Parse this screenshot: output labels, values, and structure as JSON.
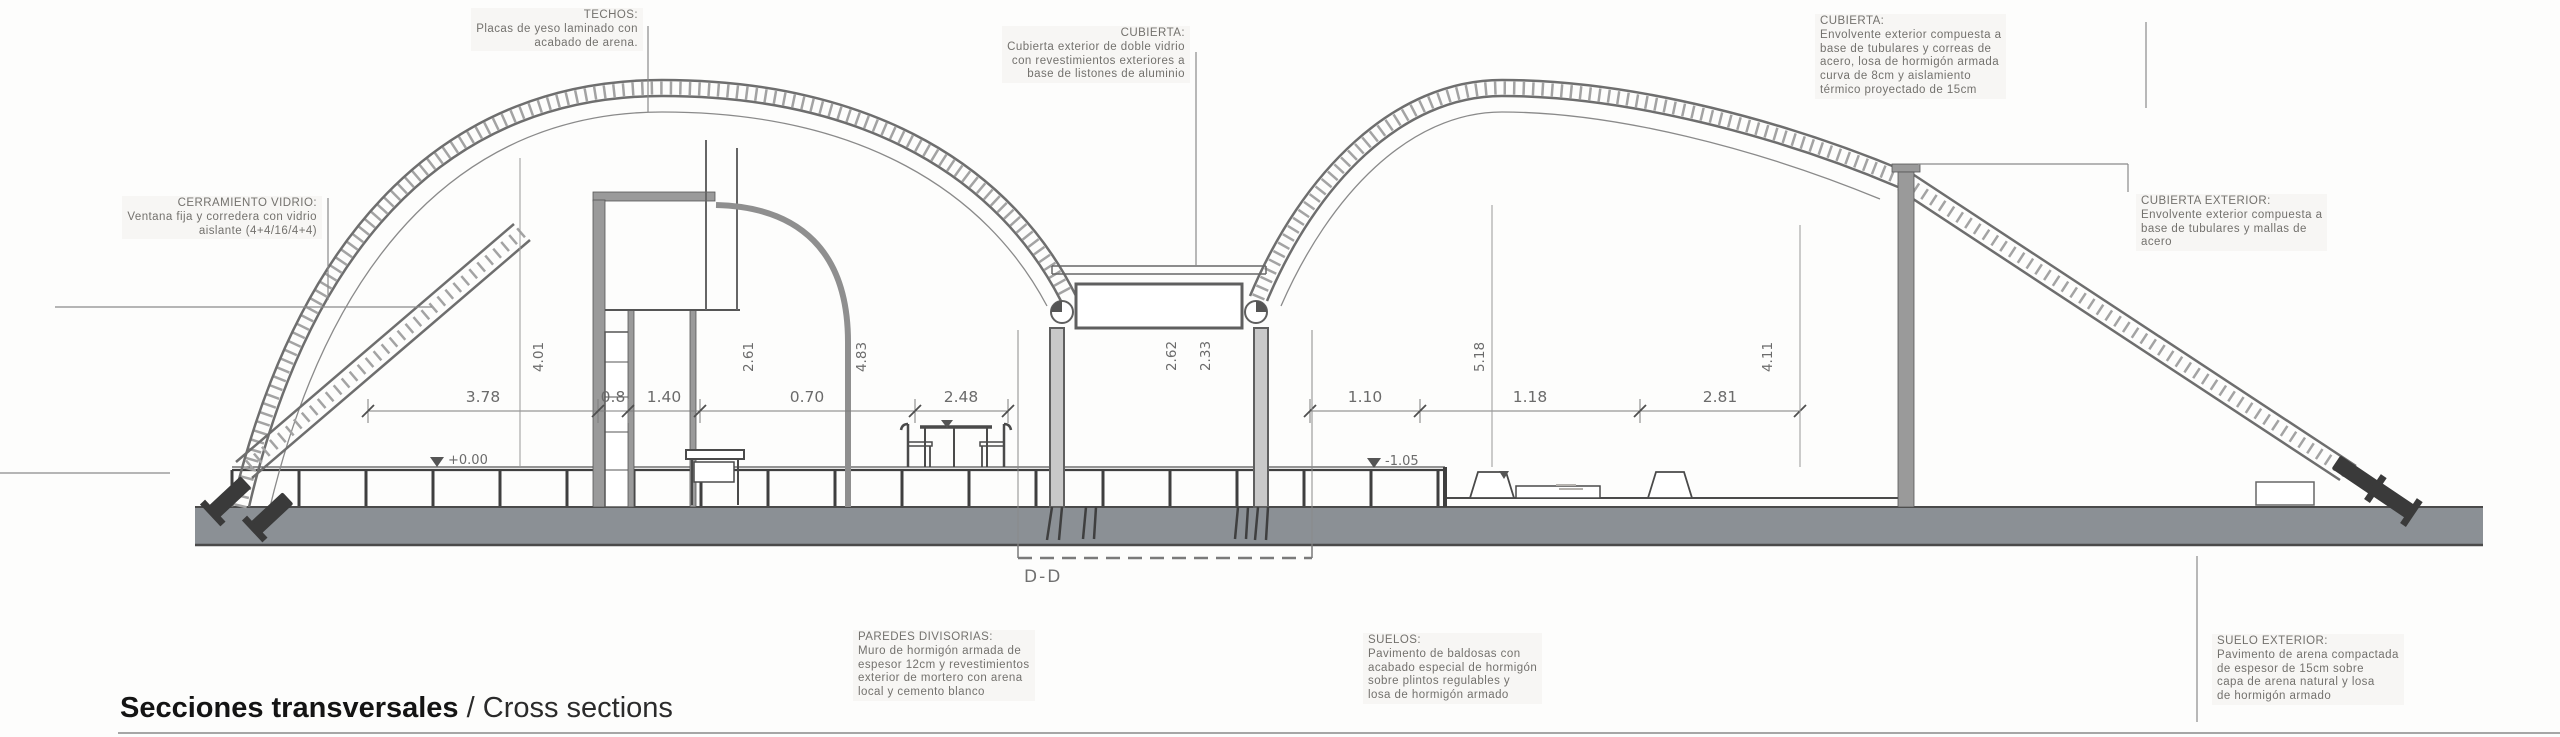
{
  "page": {
    "title_es": "Secciones transversales",
    "title_sep": "/",
    "title_en": "Cross sections"
  },
  "annotations": {
    "techos": {
      "heading": "TECHOS:",
      "lines": [
        "Placas de yeso laminado con",
        "acabado de arena."
      ]
    },
    "cubierta_central": {
      "heading": "CUBIERTA:",
      "lines": [
        "Cubierta exterior de doble vidrio",
        "con revestimientos exteriores a",
        "base de listones de aluminio"
      ]
    },
    "cubierta_derecha": {
      "heading": "CUBIERTA:",
      "lines": [
        "Envolvente exterior compuesta a",
        "base de tubulares y correas de",
        "acero, losa de hormigón armada",
        "curva de 8cm y aislamiento",
        "térmico proyectado de 15cm"
      ]
    },
    "cubierta_exterior": {
      "heading": "CUBIERTA EXTERIOR:",
      "lines": [
        "Envolvente exterior compuesta a",
        "base de tubulares y mallas de",
        "acero"
      ]
    },
    "cerramiento_vidrio": {
      "heading": "CERRAMIENTO VIDRIO:",
      "lines": [
        "Ventana fija y corredera con vidrio",
        "aislante (4+4/16/4+4)"
      ]
    },
    "paredes_divisorias": {
      "heading": "PAREDES DIVISORIAS:",
      "lines": [
        "Muro de hormigón armada de",
        "espesor 12cm y revestimientos",
        "exterior de mortero con arena",
        "local y cemento blanco"
      ]
    },
    "suelos": {
      "heading": "SUELOS:",
      "lines": [
        "Pavimento de baldosas con",
        "acabado especial de hormigón",
        "sobre plintos regulables y",
        "losa de hormigón armado"
      ]
    },
    "suelo_exterior": {
      "heading": "SUELO EXTERIOR:",
      "lines": [
        "Pavimento de arena compactada",
        "de espesor de 15cm sobre",
        "capa de arena natural y losa",
        "de hormigón armado"
      ]
    }
  },
  "dimensions": {
    "left_span": [
      "3.78",
      "0.8",
      "1.40",
      "0.70",
      "2.48"
    ],
    "right_span": [
      "1.10",
      "1.18",
      "2.81"
    ],
    "vertical_left": [
      "4.01",
      "2.61",
      "4.83"
    ],
    "vertical_center": [
      "2.62",
      "2.33"
    ],
    "vertical_right": [
      "5.18",
      "4.11"
    ],
    "levels": {
      "left_floor": "+0.00",
      "right_floor": "-1.05"
    },
    "section_mark": "D-D"
  },
  "colors": {
    "drawing_line": "#6e6e6e",
    "slab_gray": "#8b9095",
    "anchor_dark": "#3a3a3a",
    "annotation_text": "#73716d",
    "title_text": "#141414"
  }
}
